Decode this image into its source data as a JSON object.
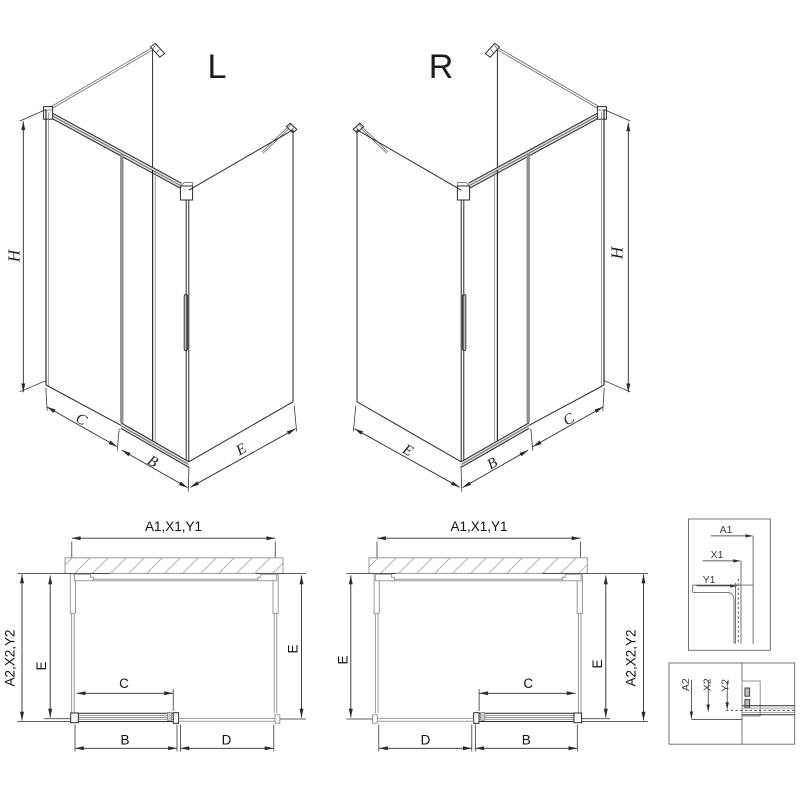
{
  "drawing": {
    "iso_left": {
      "label": "L",
      "dim_h": "H",
      "dim_c": "C",
      "dim_b": "B",
      "dim_e": "E"
    },
    "iso_right": {
      "label": "R",
      "dim_h": "H",
      "dim_c": "C",
      "dim_b": "B",
      "dim_e": "E"
    },
    "plan_left": {
      "dim_top": "A1,X1,Y1",
      "dim_left_outer": "A2,X2,Y2",
      "dim_left_inner": "E",
      "dim_right": "E",
      "dim_c": "C",
      "dim_b": "B",
      "dim_d": "D"
    },
    "plan_right": {
      "dim_top": "A1,X1,Y1",
      "dim_left": "E",
      "dim_right_inner": "E",
      "dim_right_outer": "A2,X2,Y2",
      "dim_c": "C",
      "dim_d": "D",
      "dim_b": "B"
    },
    "detail_top": {
      "dim_a1": "A1",
      "dim_x1": "X1",
      "dim_y1": "Y1"
    },
    "detail_bottom": {
      "dim_a2": "A2",
      "dim_x2": "X2",
      "dim_y2": "Y2"
    }
  },
  "colors": {
    "line": "#2b2b2b",
    "glass_gray": "#999999",
    "door_edge_gray": "#8f8f8f",
    "wall_hatch": "#b5b5b5",
    "rail_fill": "#d9d9d9"
  }
}
